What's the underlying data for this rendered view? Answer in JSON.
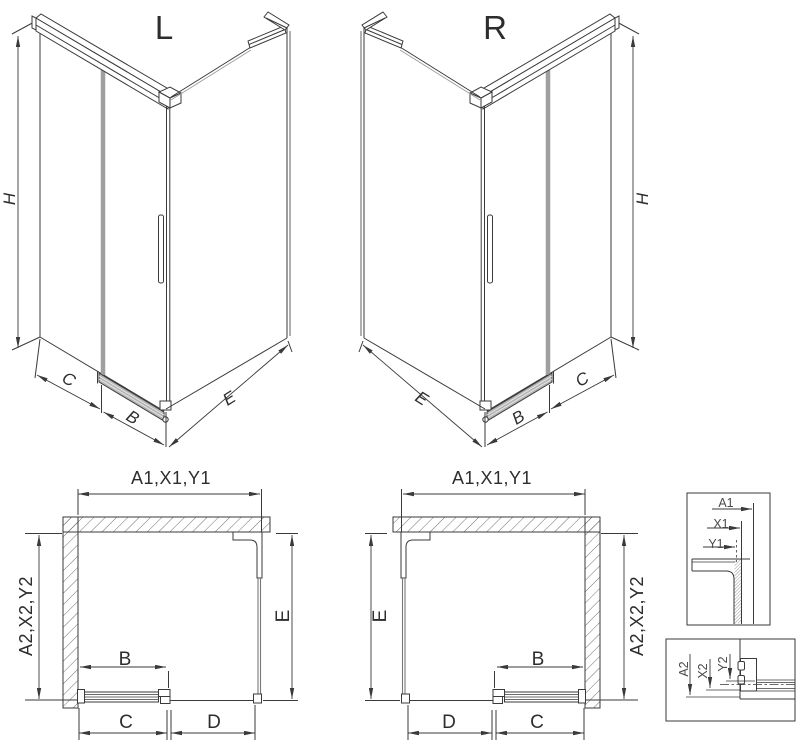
{
  "colors": {
    "line": "#3a3a3a",
    "glass_gray": "#9f9f9f",
    "rail_gray": "#b5b5b5",
    "label": "#2d2d2d",
    "detail_label": "#4a4a4a",
    "background": "#ffffff"
  },
  "iso_left": {
    "title": "L",
    "dim_height": "H",
    "dim_fixed": "C",
    "dim_door": "B",
    "dim_side": "E"
  },
  "iso_right": {
    "title": "R",
    "dim_height": "H",
    "dim_fixed": "C",
    "dim_door": "B",
    "dim_side": "E"
  },
  "plan_left": {
    "dim_width": "A1,X1,Y1",
    "dim_depth": "A2,X2,Y2",
    "dim_side": "E",
    "dim_door": "B",
    "dim_c": "C",
    "dim_d": "D"
  },
  "plan_right": {
    "dim_width": "A1,X1,Y1",
    "dim_depth": "A2,X2,Y2",
    "dim_side": "E",
    "dim_door": "B",
    "dim_c": "C",
    "dim_d": "D"
  },
  "detail_top": {
    "labels": [
      "A1",
      "X1",
      "Y1"
    ]
  },
  "detail_bottom": {
    "labels": [
      "A2",
      "X2",
      "Y2"
    ]
  }
}
